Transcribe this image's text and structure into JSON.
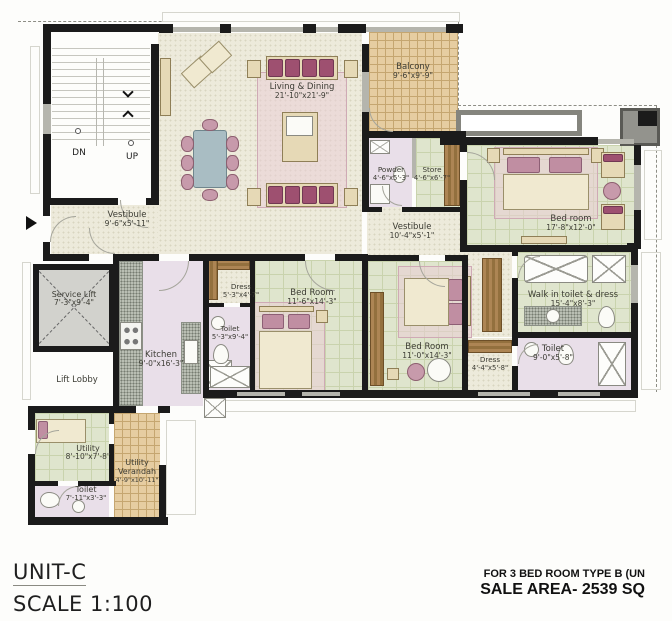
{
  "unit": {
    "title": "UNIT-C",
    "scale": "SCALE 1:100"
  },
  "sale_note": {
    "line1": "FOR 3 BED ROOM TYPE B (UN",
    "line2": "SALE AREA- 2539 SQ"
  },
  "stairs": {
    "down": "DN",
    "up": "UP"
  },
  "rooms": {
    "living": {
      "name": "Living & Dining",
      "dims": "21'-10\"x21'-9\""
    },
    "balcony": {
      "name": "Balcony",
      "dims": "9'-6\"x9'-9\""
    },
    "vestibule1": {
      "name": "Vestibule",
      "dims": "9'-6\"x5'-11\""
    },
    "vestibule2": {
      "name": "Vestibule",
      "dims": "10'-4\"x5'-1\""
    },
    "powder": {
      "name": "Powder",
      "dims": "4'-6\"x5'-3\""
    },
    "store": {
      "name": "Store",
      "dims": "4'-6\"x6'-7\""
    },
    "bedroom1": {
      "name": "Bed room",
      "dims": "17'-8\"x12'-0\""
    },
    "walkin": {
      "name": "Walk in toilet & dress",
      "dims": "15'-4\"x8'-3\""
    },
    "bedroom2": {
      "name": "Bed Room",
      "dims": "11'-6\"x14'-3\""
    },
    "dress1": {
      "name": "Dress",
      "dims": "5'-3\"x4'-7\""
    },
    "toilet1": {
      "name": "Toilet",
      "dims": "5'-3\"x9'-4\""
    },
    "bedroom3": {
      "name": "Bed Room",
      "dims": "11'-0\"x14'-3\""
    },
    "dress2": {
      "name": "Dress",
      "dims": "4'-4\"x5'-8\""
    },
    "toilet2": {
      "name": "Toilet",
      "dims": "9'-0\"x5'-8\""
    },
    "kitchen": {
      "name": "Kitchen",
      "dims": "9'-0\"x16'-3\""
    },
    "service_lift": {
      "name": "Service Lift",
      "dims": "7'-3\"x9'-4\""
    },
    "lift_lobby": {
      "name": "Lift Lobby",
      "dims": ""
    },
    "utility": {
      "name": "Utility",
      "dims": "8'-10\"x7'-8\""
    },
    "utility_verandah": {
      "name": "Utility",
      "name2": "Verandah",
      "dims": "4'-9\"x10'-11\""
    },
    "toilet3": {
      "name": "Toilet",
      "dims": "7'-11\"x3'-3\""
    }
  },
  "colors": {
    "wall": "#1b1b1b",
    "floor_cream": "#edeadb",
    "tile_green": "#dfe5cd",
    "tile_tan": "#e6cda1",
    "floor_lavender": "#e9dfe9",
    "rug_pink": "#ecd9de",
    "sofa_maroon": "#9e5070",
    "wood": "#a2794a",
    "window_gray": "#b5b5ad"
  }
}
